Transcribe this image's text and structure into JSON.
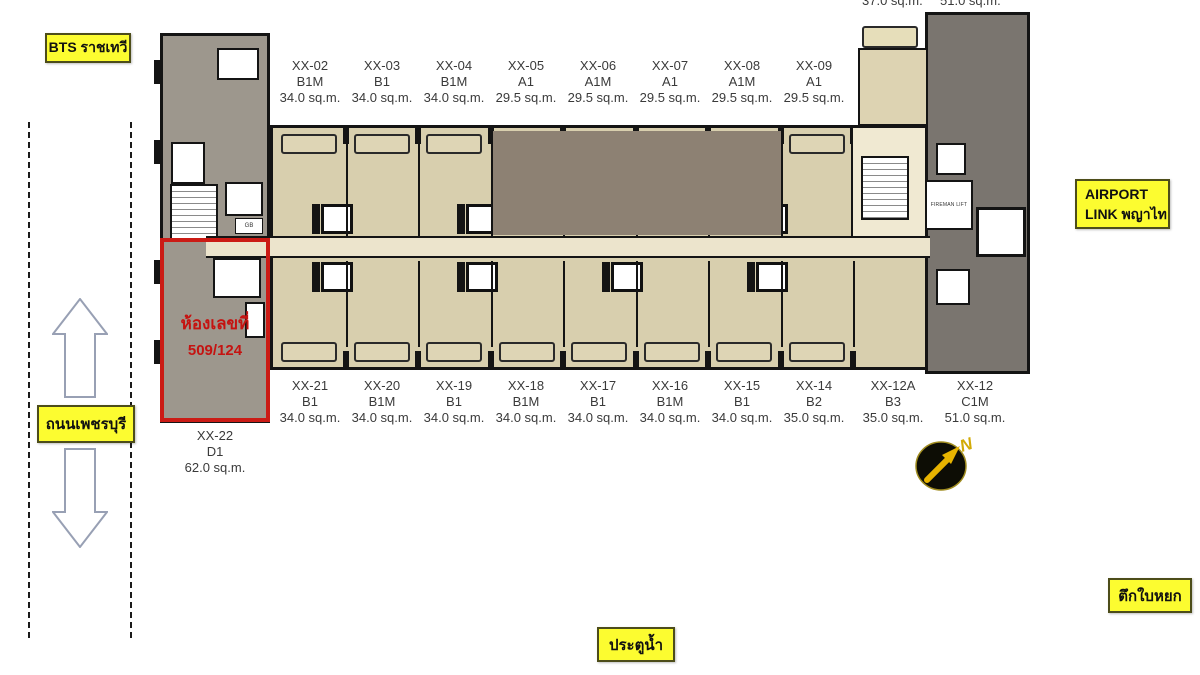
{
  "landmarks": {
    "bts": "BTS ราชเทวี",
    "airport_link_line1": "AIRPORT",
    "airport_link_line2": "LINK พญาไท",
    "road": "ถนนเพชรบุรี",
    "pratunam": "ประตูน้ำ",
    "baiyoke": "ตึกใบหยก"
  },
  "highlight": {
    "title": "ห้องเลขที่",
    "room_no": "509/124"
  },
  "partial_areas": {
    "left": "37.0 sq.m.",
    "right": "51.0 sq.m."
  },
  "plan_texts": {
    "fireman_lift": "FIREMAN LIFT",
    "gb": "GB",
    "compass_n": "N"
  },
  "units": {
    "top": [
      {
        "code": "XX-02",
        "type": "B1M",
        "area": "34.0 sq.m."
      },
      {
        "code": "XX-03",
        "type": "B1",
        "area": "34.0 sq.m."
      },
      {
        "code": "XX-04",
        "type": "B1M",
        "area": "34.0 sq.m."
      },
      {
        "code": "XX-05",
        "type": "A1",
        "area": "29.5 sq.m."
      },
      {
        "code": "XX-06",
        "type": "A1M",
        "area": "29.5 sq.m."
      },
      {
        "code": "XX-07",
        "type": "A1",
        "area": "29.5 sq.m."
      },
      {
        "code": "XX-08",
        "type": "A1M",
        "area": "29.5 sq.m."
      },
      {
        "code": "XX-09",
        "type": "A1",
        "area": "29.5 sq.m."
      }
    ],
    "bottom": [
      {
        "code": "XX-21",
        "type": "B1",
        "area": "34.0 sq.m."
      },
      {
        "code": "XX-20",
        "type": "B1M",
        "area": "34.0 sq.m."
      },
      {
        "code": "XX-19",
        "type": "B1",
        "area": "34.0 sq.m."
      },
      {
        "code": "XX-18",
        "type": "B1M",
        "area": "34.0 sq.m."
      },
      {
        "code": "XX-17",
        "type": "B1",
        "area": "34.0 sq.m."
      },
      {
        "code": "XX-16",
        "type": "B1M",
        "area": "34.0 sq.m."
      },
      {
        "code": "XX-15",
        "type": "B1",
        "area": "34.0 sq.m."
      },
      {
        "code": "XX-14",
        "type": "B2",
        "area": "35.0 sq.m."
      },
      {
        "code": "XX-12A",
        "type": "B3",
        "area": "35.0 sq.m."
      },
      {
        "code": "XX-12",
        "type": "C1M",
        "area": "51.0 sq.m."
      }
    ],
    "corner": {
      "code": "XX-22",
      "type": "D1",
      "area": "62.0 sq.m."
    }
  },
  "colors": {
    "highlight_red": "#cb1b15",
    "label_yellow": "#fcfc30",
    "unit_beige": "#d8cfae",
    "unit_dark_brown": "#8d8173",
    "tower_grey": "#9d978d",
    "tower_dark_grey": "#7a756f",
    "corridor": "#ece4cc",
    "compass_gold": "#e8b400"
  }
}
